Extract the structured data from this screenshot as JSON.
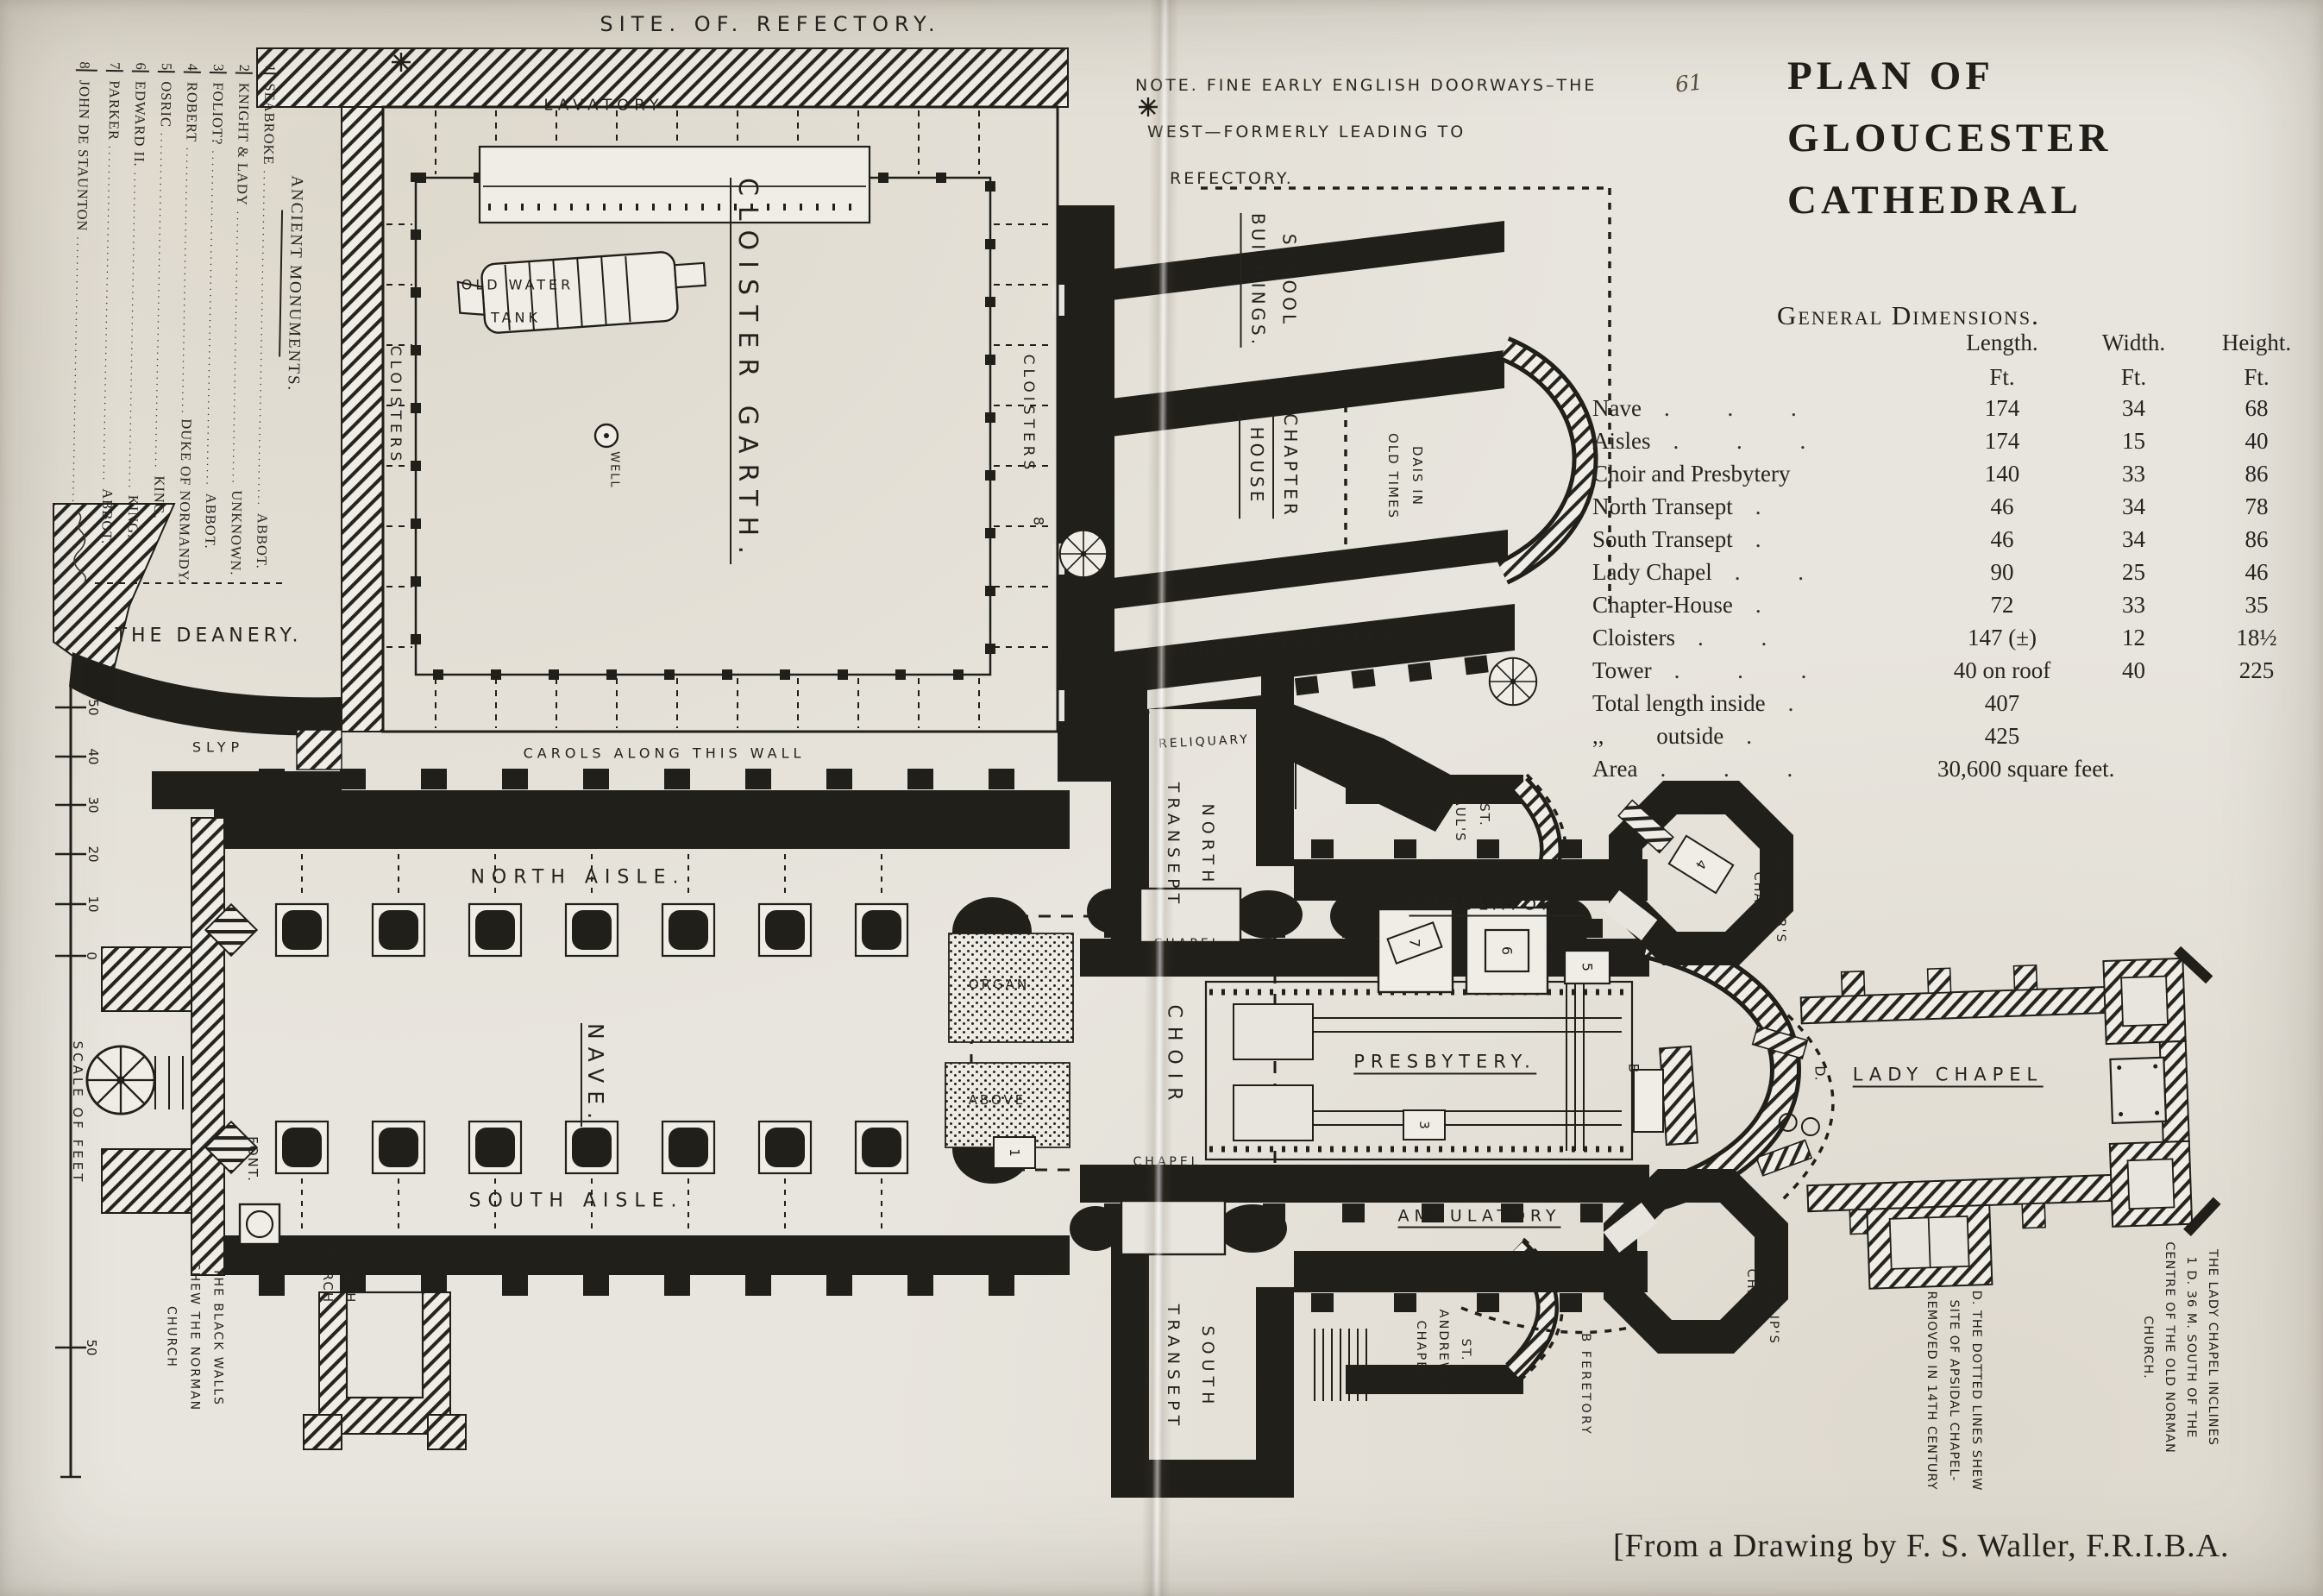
{
  "colors": {
    "paper": "#e8e5de",
    "ink": "#211f1a"
  },
  "page": {
    "number": "61"
  },
  "title": {
    "line1": "PLAN OF",
    "line2": "GLOUCESTER",
    "line3": "CATHEDRAL"
  },
  "dimensions": {
    "heading": "General Dimensions.",
    "col_headers": {
      "length": "Length.",
      "width": "Width.",
      "height": "Height."
    },
    "units": {
      "length": "Ft.",
      "width": "Ft.",
      "height": "Ft."
    },
    "rows": [
      {
        "name": "Nave",
        "leader": ". . .",
        "length": "174",
        "width": "34",
        "height": "68"
      },
      {
        "name": "Aisles",
        "leader": ". . .",
        "length": "174",
        "width": "15",
        "height": "40"
      },
      {
        "name": "Choir and Presbytery",
        "leader": "",
        "length": "140",
        "width": "33",
        "height": "86"
      },
      {
        "name": "North Transept",
        "leader": ".",
        "length": "46",
        "width": "34",
        "height": "78"
      },
      {
        "name": "South Transept",
        "leader": ".",
        "length": "46",
        "width": "34",
        "height": "86"
      },
      {
        "name": "Lady Chapel",
        "leader": ". .",
        "length": "90",
        "width": "25",
        "height": "46"
      },
      {
        "name": "Chapter-House",
        "leader": ".",
        "length": "72",
        "width": "33",
        "height": "35"
      },
      {
        "name": "Cloisters",
        "leader": ". .",
        "length": "147 (±)",
        "width": "12",
        "height": "18½"
      },
      {
        "name": "Tower",
        "leader": ". . .",
        "length": "40 on roof",
        "width": "40",
        "height": "225"
      },
      {
        "name": "Total length inside",
        "leader": ".",
        "length": "407",
        "width": "",
        "height": ""
      },
      {
        "name": ",,         outside",
        "leader": ".",
        "length": "425",
        "width": "",
        "height": ""
      },
      {
        "name": "Area",
        "leader": ". . .",
        "length": "30,600 square feet.",
        "width": "",
        "height": ""
      }
    ]
  },
  "note": {
    "line1": "NOTE. FINE EARLY ENGLISH DOORWAYS–THE",
    "line2": "WEST—FORMERLY LEADING TO",
    "line3": "REFECTORY."
  },
  "monuments": {
    "header": "ANCIENT MONUMENTS.",
    "leader_dots": "......................................................",
    "items": [
      {
        "num": "1",
        "name": "SEABROKE",
        "role": "ABBOT."
      },
      {
        "num": "2",
        "name": "KNIGHT & LADY",
        "role": "UNKNOWN."
      },
      {
        "num": "3",
        "name": "FOLIOT?",
        "role": "ABBOT."
      },
      {
        "num": "4",
        "name": "ROBERT",
        "role": "DUKE OF NORMANDY."
      },
      {
        "num": "5",
        "name": "OSRIC",
        "role": "KING."
      },
      {
        "num": "6",
        "name": "EDWARD II.",
        "role": "KING."
      },
      {
        "num": "7",
        "name": "PARKER",
        "role": "ABBOT."
      },
      {
        "num": "8",
        "name": "JOHN DE STAUNTON",
        "role": ""
      }
    ]
  },
  "scale": {
    "label": "SCALE OF FEET",
    "ticks": [
      "50",
      "40",
      "30",
      "20",
      "10",
      "0",
      "50"
    ]
  },
  "attribution": "[From a Drawing by F. S. Waller, F.R.I.B.A.",
  "plan_labels": {
    "site_of_refectory": "SITE. OF. REFECTORY.",
    "lavatory": "LAVATORY",
    "old_water_tank_1": "OLD WATER",
    "old_water_tank_2": "TANK",
    "cloister_garth": "CLOISTER GARTH.",
    "well": "WELL",
    "cloisters_west": "CLOISTERS",
    "cloisters_east": "CLOISTERS",
    "school_1": "SCHOOL",
    "school_2": "BUILDINGS.",
    "chapter_1": "CHAPTER",
    "chapter_2": "HOUSE",
    "dais_1": "DAIS IN",
    "dais_2": "OLD TIMES",
    "abbots_cloister": "ABBOT'S CLOISTER.",
    "reliquary": "RELIQUARY",
    "north_transept_1": "NORTH",
    "north_transept_2": "TRANSEPT",
    "south_transept_1": "SOUTH",
    "south_transept_2": "TRANSEPT",
    "st_pauls_1": "ST.",
    "st_pauls_2": "PAUL'S",
    "st_pauls_3": "CH.",
    "the_deanery": "THE DEANERY.",
    "slyp": "SLYP",
    "carols": "CAROLS ALONG THIS WALL",
    "north_aisle": "NORTH AISLE.",
    "nave": "NAVE.",
    "south_aisle": "SOUTH AISLE.",
    "organ": "ORGAN",
    "above": "ABOVE",
    "choir": "CHOIR",
    "chapel_north": "CHAPEL",
    "chapel_south": "CHAPEL",
    "presbytery": "PRESBYTERY.",
    "ambulatory_north": "AMBULATORY,",
    "ambulatory_south": "AMBULATORY",
    "lady_chapel": "LADY CHAPEL",
    "boteler_1": "BOTELER'S",
    "boteler_2": "CHAPEL",
    "st_philips_1": "ST. PHILIP'S",
    "st_philips_2": "CHAPEL",
    "st_andrews_1": "ST.",
    "st_andrews_2": "ANDREW'S",
    "st_andrews_3": "CHAPEL",
    "feretory": "B   FERETORY",
    "font": "FONT.",
    "south_porch_1": "SOUTH",
    "south_porch_2": "PORCH",
    "black_walls_1": "THE BLACK WALLS",
    "black_walls_2": "SHEW THE NORMAN",
    "black_walls_3": "CHURCH",
    "dotted_note_1": "D. THE DOTTED LINES SHEW",
    "dotted_note_2": "SITE OF APSIDAL CHAPEL-",
    "dotted_note_3": "REMOVED IN 14TH CENTURY",
    "incline_note_1": "THE LADY CHAPEL INCLINES",
    "incline_note_2": "1 D. 36 M. SOUTH OF THE",
    "incline_note_3": "CENTRE OF THE OLD NORMAN",
    "incline_note_4": "CHURCH."
  },
  "markers": {
    "m1": "1",
    "m2": "2",
    "m3": "3",
    "m4": "4",
    "m5": "5",
    "m6": "6",
    "m7": "7",
    "m8": "8",
    "letter_b": "B",
    "letter_d": "D."
  }
}
